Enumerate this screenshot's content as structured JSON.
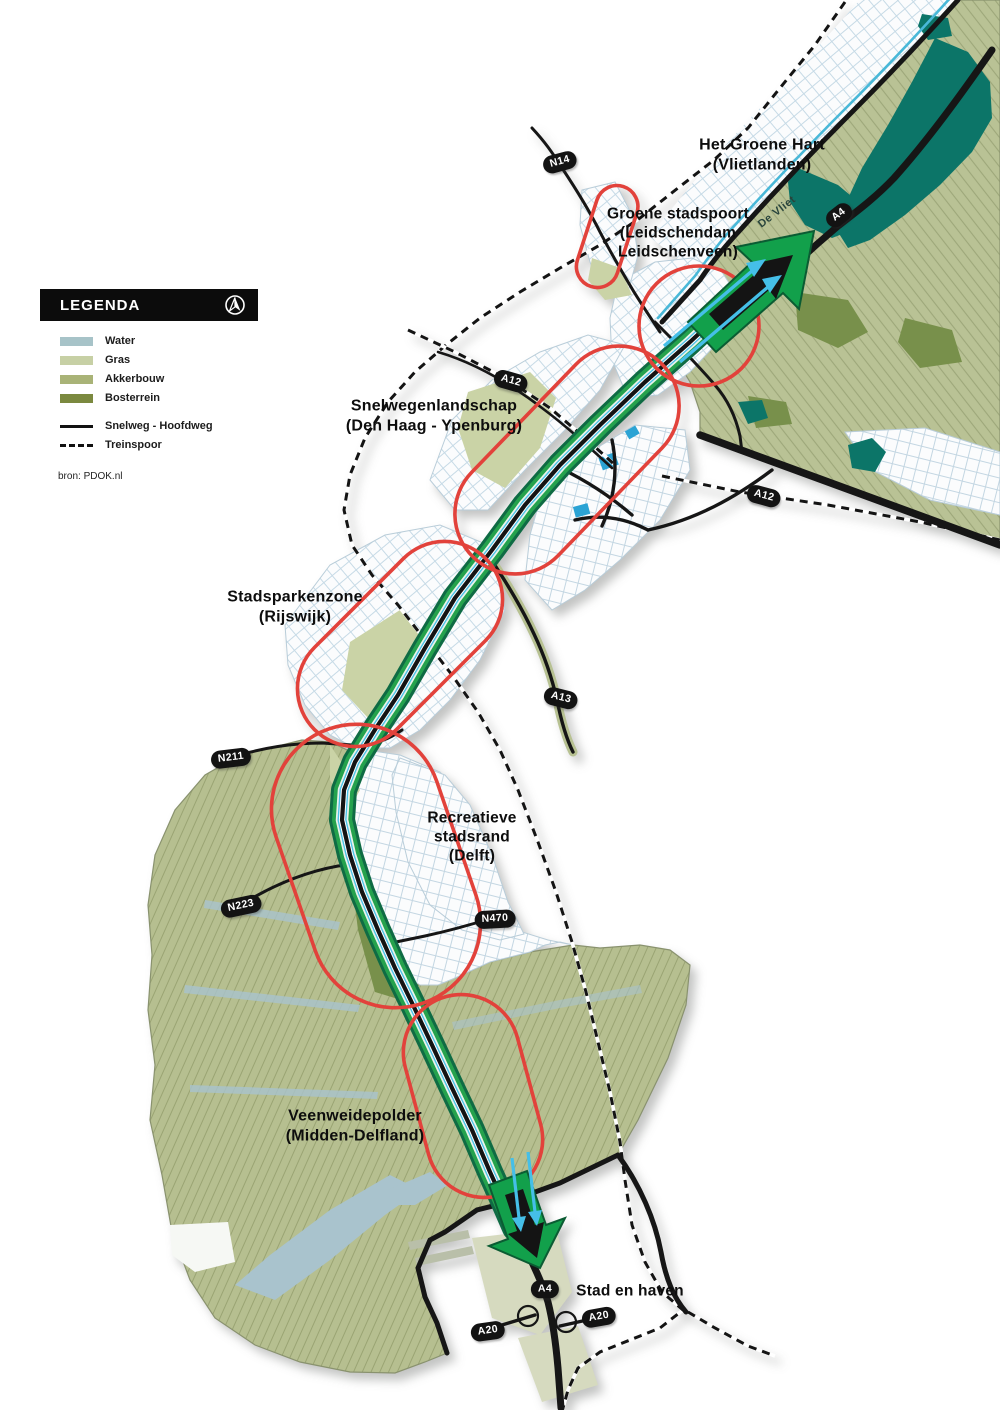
{
  "legend": {
    "title": "LEGENDA",
    "source": "bron: PDOK.nl",
    "items": [
      {
        "label": "Water",
        "color": "#a7c3c8",
        "css": "background:#a7c3c8"
      },
      {
        "label": "Gras",
        "color": "#c7d0a5",
        "css": "background:#c7d0a5"
      },
      {
        "label": "Akkerbouw",
        "color": "#a9b377",
        "css": "background:#a9b377"
      },
      {
        "label": "Bosterrein",
        "color": "#7b893f",
        "css": "background:#7b893f"
      }
    ],
    "lines": [
      {
        "label": "Snelweg - Hoofdweg",
        "style": "solid"
      },
      {
        "label": "Treinspoor",
        "style": "dashed"
      }
    ]
  },
  "zones": [
    {
      "label": "Het Groene Hart\n(Vlietlanden)"
    },
    {
      "label": "Groene stadspoort\n(Leidschendam\nLeidschenveen)"
    },
    {
      "label": "Snelwegenlandschap\n(Den Haag - Ypenburg)"
    },
    {
      "label": "Stadsparkenzone\n(Rijswijk)"
    },
    {
      "label": "Recreatieve\nstadsrand\n(Delft)"
    },
    {
      "label": "Veenweidepolder\n(Midden-Delfland)"
    },
    {
      "label": "Stad en haven"
    }
  ],
  "badges": [
    {
      "label": "N14"
    },
    {
      "label": "A4"
    },
    {
      "label": "A12"
    },
    {
      "label": "A12"
    },
    {
      "label": "A13"
    },
    {
      "label": "N211"
    },
    {
      "label": "N223"
    },
    {
      "label": "N470"
    },
    {
      "label": "A4"
    },
    {
      "label": "A20"
    },
    {
      "label": "A20"
    }
  ],
  "river_label": "De Vliet",
  "colors": {
    "zone_outline": "#e2423b",
    "corridor_green": "#25a24d",
    "corridor_cyan": "#4cc2e8",
    "lake_teal": "#0c7568",
    "arrow_green": "#12a04b",
    "land": "#b9c295"
  }
}
